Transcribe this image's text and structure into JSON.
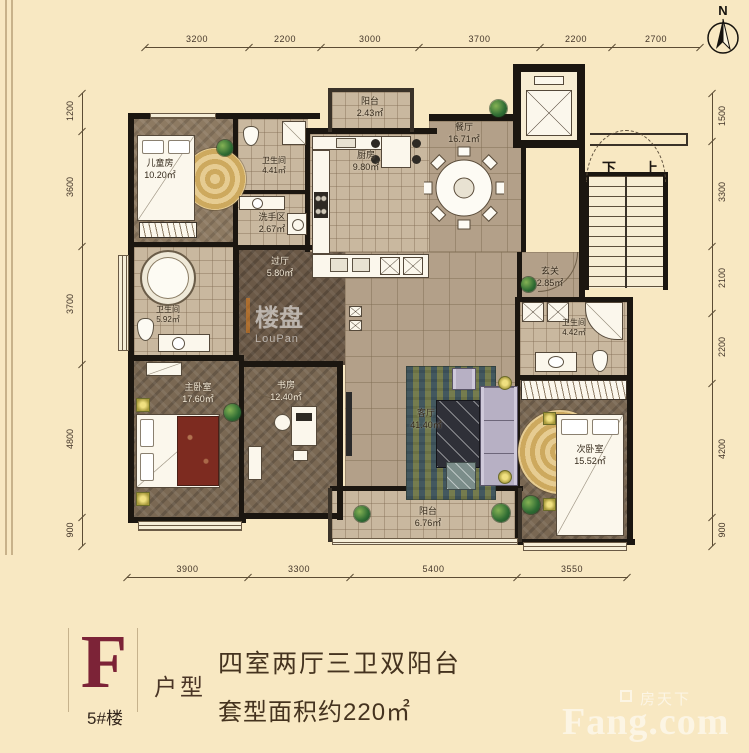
{
  "colors": {
    "background": "#f8e8c2",
    "wall": "#1b1610",
    "accent_maroon": "#7c2337",
    "dim_text": "#44362a",
    "brand_watermark": "#f6eed8"
  },
  "compass": {
    "label": "N"
  },
  "dimensions": {
    "top": [
      "3200",
      "2200",
      "3000",
      "3700",
      "2200",
      "2700"
    ],
    "bottom": [
      "3900",
      "3300",
      "5400",
      "3550"
    ],
    "left": [
      "1200",
      "3600",
      "3700",
      "4800",
      "900"
    ],
    "right": [
      "1500",
      "3300",
      "2100",
      "2200",
      "4200",
      "900"
    ]
  },
  "rooms": [
    {
      "name": "儿童房",
      "area": "10.20㎡"
    },
    {
      "name": "阳台",
      "area": "2.43㎡"
    },
    {
      "name": "厨房",
      "area": "9.80㎡"
    },
    {
      "name": "餐厅",
      "area": "16.71㎡"
    },
    {
      "name": "卫生间",
      "area": "4.41㎡"
    },
    {
      "name": "洗手区",
      "area": "2.67㎡"
    },
    {
      "name": "过厅",
      "area": "5.80㎡"
    },
    {
      "name": "卫生间",
      "area": "5.92㎡"
    },
    {
      "name": "主卧室",
      "area": "17.60㎡"
    },
    {
      "name": "书房",
      "area": "12.40㎡"
    },
    {
      "name": "客厅",
      "area": "41.40㎡"
    },
    {
      "name": "玄关",
      "area": "2.85㎡"
    },
    {
      "name": "卫生间",
      "area": "4.42㎡"
    },
    {
      "name": "次卧室",
      "area": "15.52㎡"
    },
    {
      "name": "阳台",
      "area": "6.76㎡"
    }
  ],
  "stairs": {
    "down": "下",
    "up": "上"
  },
  "watermark_plan": {
    "text": "楼盘",
    "sub": "LouPan"
  },
  "info": {
    "type_letter": "F",
    "building": "5#楼",
    "type_label": "户型",
    "line1": "四室两厅三卫双阳台",
    "line2": "套型面积约220㎡"
  },
  "brand": {
    "cn": "房天下",
    "en": "Fang.com"
  }
}
